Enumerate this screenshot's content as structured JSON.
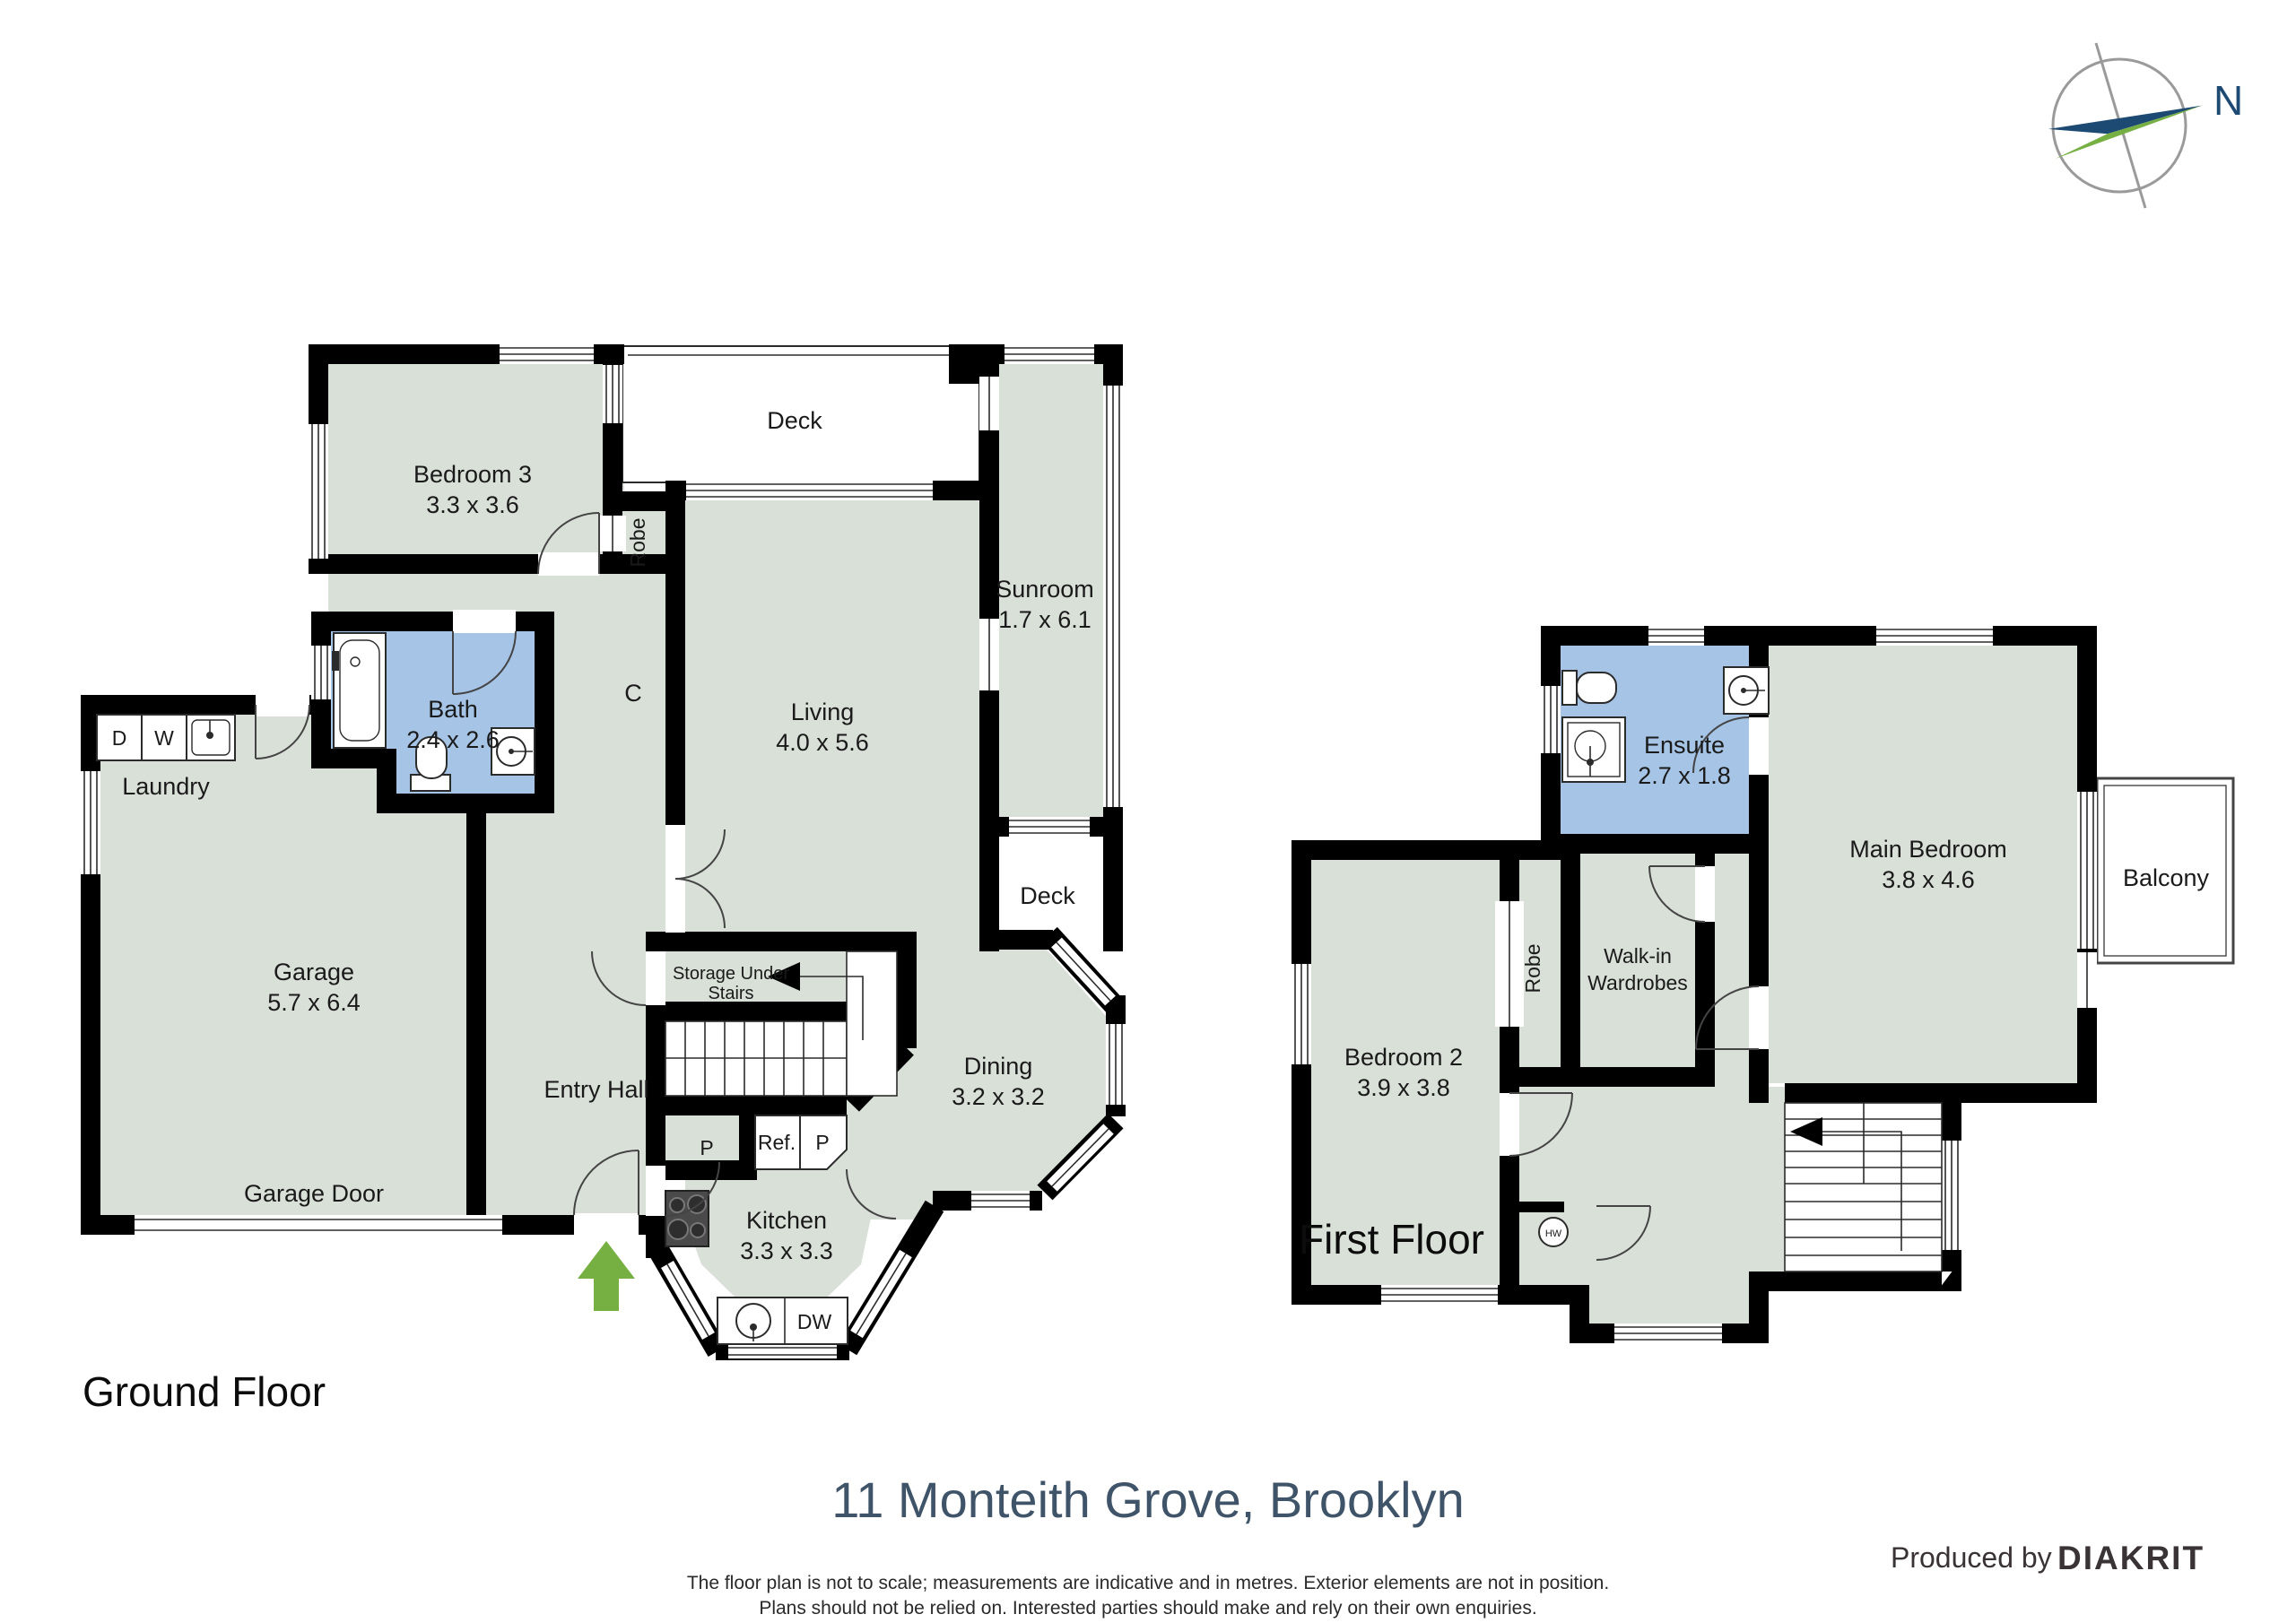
{
  "compass": {
    "label": "N"
  },
  "ground": {
    "floor_label": "Ground Floor",
    "rooms": {
      "bedroom3": {
        "name": "Bedroom 3",
        "dims": "3.3 x 3.6"
      },
      "deck_top": {
        "name": "Deck"
      },
      "sunroom": {
        "name": "Sunroom",
        "dims": "1.7 x 6.1"
      },
      "living": {
        "name": "Living",
        "dims": "4.0 x 5.6"
      },
      "robe": {
        "name": "Robe"
      },
      "closet": {
        "name": "C"
      },
      "bath": {
        "name": "Bath",
        "dims": "2.4 x 2.6"
      },
      "laundry": {
        "name": "Laundry"
      },
      "dryer": "D",
      "washer": "W",
      "garage": {
        "name": "Garage",
        "dims": "5.7 x 6.4"
      },
      "garage_door": "Garage Door",
      "entry_hall": "Entry Hall",
      "storage": {
        "line1": "Storage Under",
        "line2": "Stairs"
      },
      "pantry1": "P",
      "fridge": "Ref.",
      "pantry2": "P",
      "dining": {
        "name": "Dining",
        "dims": "3.2 x 3.2"
      },
      "deck_right": {
        "name": "Deck"
      },
      "kitchen": {
        "name": "Kitchen",
        "dims": "3.3 x 3.3"
      },
      "dishwasher": "DW"
    }
  },
  "first": {
    "floor_label": "First Floor",
    "rooms": {
      "ensuite": {
        "name": "Ensuite",
        "dims": "2.7 x 1.8"
      },
      "main_bedroom": {
        "name": "Main Bedroom",
        "dims": "3.8 x 4.6"
      },
      "balcony": {
        "name": "Balcony"
      },
      "bedroom2": {
        "name": "Bedroom 2",
        "dims": "3.9 x 3.8"
      },
      "robe": {
        "name": "Robe"
      },
      "walkin": {
        "line1": "Walk-in",
        "line2": "Wardrobes"
      },
      "hot_water": "HW"
    }
  },
  "footer": {
    "title": "11 Monteith Grove, Brooklyn",
    "disclaimer1": "The floor plan is not to scale; measurements are indicative and in metres. Exterior elements are not in position.",
    "disclaimer2": "Plans should not be relied on. Interested parties should make and rely on their own enquiries.",
    "produced_by": "Produced by",
    "brand": "DIAKRIT"
  },
  "colors": {
    "room_fill": "#d9e0d8",
    "wet_area_fill": "#a6c4e6",
    "wall": "#000000",
    "accent_green": "#76b043",
    "accent_navy": "#1c4a73",
    "title_color": "#3f5469"
  }
}
